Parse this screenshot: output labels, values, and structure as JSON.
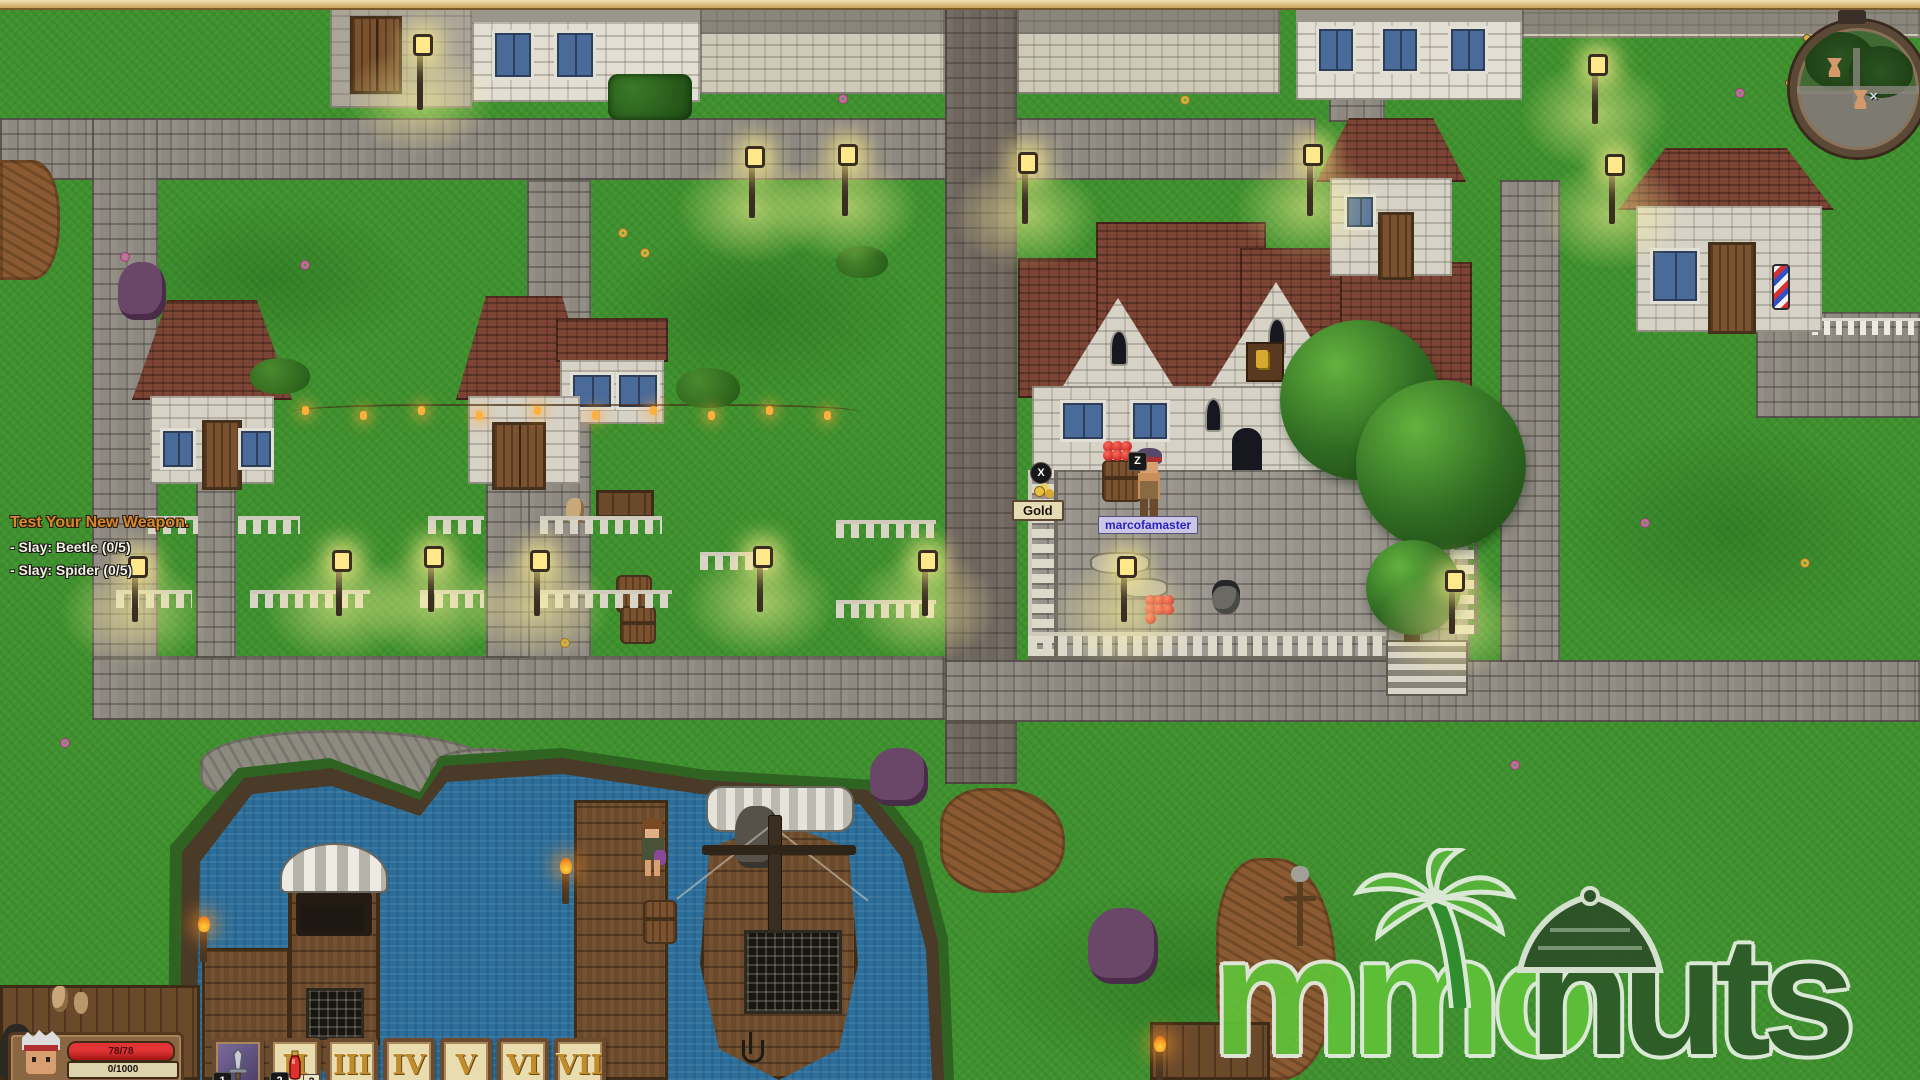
{
  "quest_tracker": {
    "title": "Test Your New Weapon.",
    "objectives": [
      "- Slay: Beetle (0/5)",
      "- Slay: Spider (0/5)"
    ]
  },
  "hud": {
    "hp": "78/78",
    "xp": "0/1000"
  },
  "hotbar": {
    "slots": [
      {
        "key": "1",
        "icon": "sword-icon"
      },
      {
        "key": "2",
        "icon": "potion-icon",
        "numeral": "II",
        "count": "2"
      },
      {
        "numeral": "III"
      },
      {
        "numeral": "IV"
      },
      {
        "numeral": "V"
      },
      {
        "numeral": "VI"
      },
      {
        "numeral": "VII"
      }
    ]
  },
  "world": {
    "player_name": "marcofamaster",
    "gold_label": "Gold",
    "interact_prompt": "Z",
    "pickup_prompt": "X"
  },
  "minimap": {
    "marker_icons": [
      "goblet-marker-icon",
      "goblet-marker-icon",
      "player-marker-icon"
    ]
  },
  "watermark": {
    "text_mmo": "mmo",
    "text_huts": "huts"
  },
  "icons": {
    "sword-icon": "css-svg-shape",
    "potion-icon": "css-svg-shape",
    "goblet-marker-icon": "css-shape",
    "player-marker-icon": "✕",
    "coin-icon": "css-shape",
    "palm-tree-icon": "svg-shape",
    "hut-icon": "svg-shape",
    "anchor-icon": "css-shape"
  },
  "colors": {
    "grass": "#3f9130",
    "road": "#8d8880",
    "roof": "#7b4434",
    "water": "#2d6f9b",
    "hp_bar": "#c41e1e",
    "quest_title": "#d8892f",
    "name_tag_text": "#2a1fc0",
    "logo_light": "#5fc238",
    "logo_dark": "#2d5a28",
    "lamp_glow": "#fff096"
  }
}
